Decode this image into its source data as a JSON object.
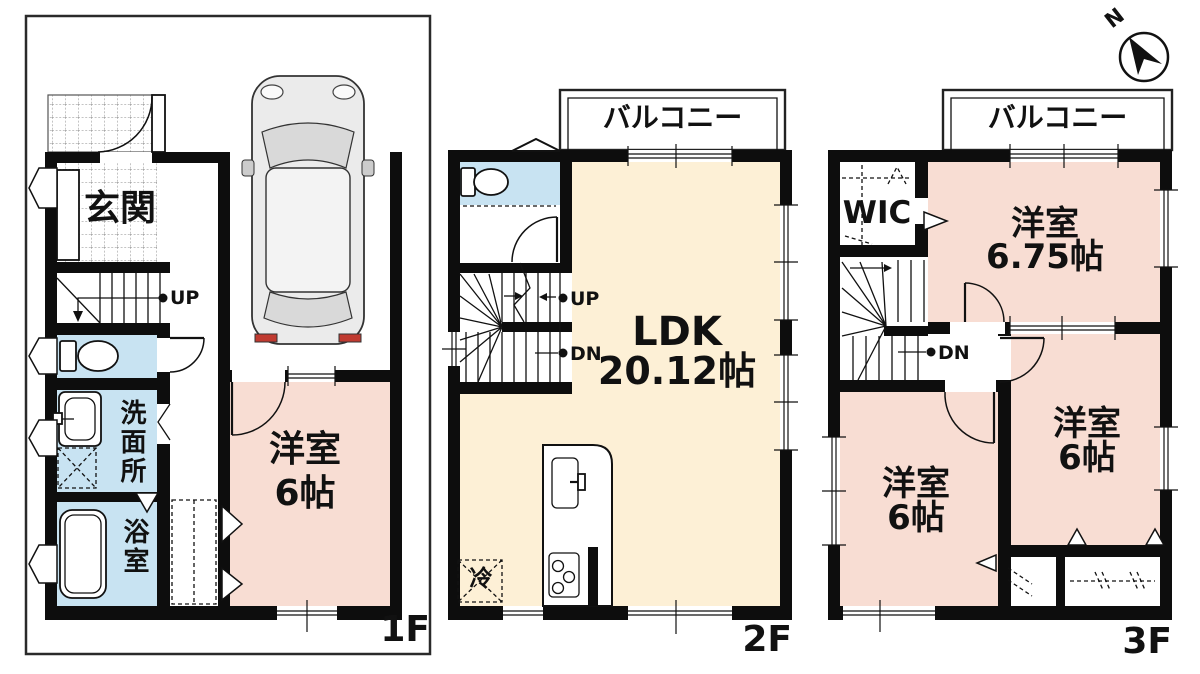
{
  "compass": {
    "north_label": "N"
  },
  "floor_1f": {
    "floor_label": "1F",
    "entrance": "玄関",
    "washroom": "洗面所",
    "bathroom": "浴室",
    "western_room_name": "洋室",
    "western_room_size": "6帖",
    "stairs_up": "UP"
  },
  "floor_2f": {
    "floor_label": "2F",
    "balcony": "バルコニー",
    "ldk_name": "LDK",
    "ldk_size": "20.12帖",
    "refrigerator": "冷",
    "stairs_up": "UP",
    "stairs_down": "DN"
  },
  "floor_3f": {
    "floor_label": "3F",
    "balcony": "バルコニー",
    "wic": "WIC",
    "western_room_1_name": "洋室",
    "western_room_1_size": "6.75帖",
    "western_room_2_name": "洋室",
    "western_room_2_size": "6帖",
    "western_room_3_name": "洋室",
    "western_room_3_size": "6帖",
    "stairs_down": "DN"
  },
  "colors": {
    "room_pink": "#f8ddd3",
    "room_cream": "#fdf0d6",
    "room_blue": "#c8e3f2",
    "wall": "#0d0d0d",
    "taillight_red": "#c03a30"
  }
}
